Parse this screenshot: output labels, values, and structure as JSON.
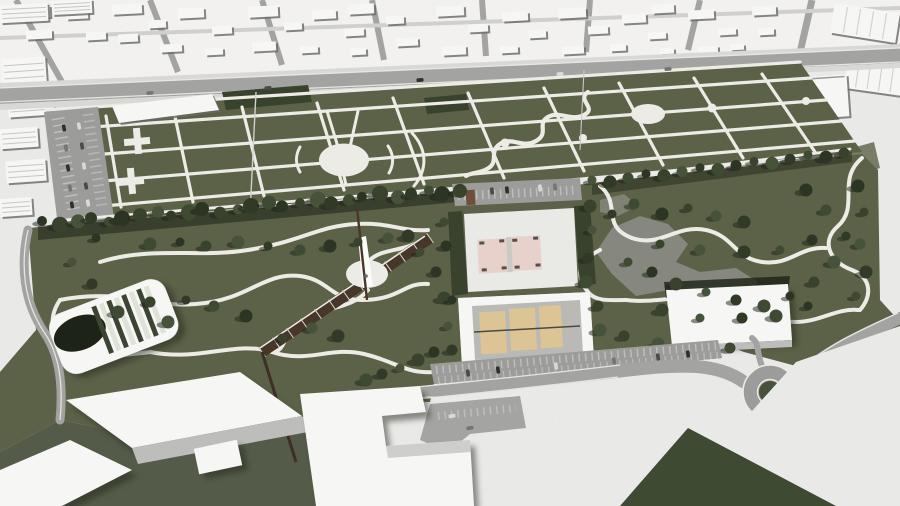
{
  "scene": {
    "description": "Aerial 3D architectural masterplan rendering: white city blocks surround a long urban park with a formal path-grid garden, two circular plazas, a serpentine walk, a forested linear park with amphitheater, observation mast on a round plaza, a diagonal stair ramp, two pink basketball courts, three sand courts, a large white hall, parking lots, a roundabout and large white buildings in the foreground",
    "court_counts": {
      "pink_courts": 2,
      "sand_courts": 3
    },
    "circular_plazas": 2,
    "roundabouts": 1
  },
  "colors": {
    "cityGround": "#e9e9e7",
    "cityBright": "#f2f1ef",
    "buildingWhite": "#f6f6f4",
    "buildingShade": "#bdbdbb",
    "buildingDark": "#4e4e4c",
    "roadGray": "#a3a3a1",
    "asphalt": "#9c9c9a",
    "sidewalk": "#d8d8d6",
    "pathWhite": "#edebe5",
    "parkGreen": "#5c6247",
    "parkGreenDeep": "#4d5539",
    "forestGreen": "#39422c",
    "shadowDeep": "#1d2317",
    "courtPink": "#e8d1ca",
    "courtSand": "#dcc494",
    "courtPadGray": "#b9bab6",
    "rampBrown": "#46372a",
    "kioskBrown": "#6f4e3b",
    "plazaGray": "#8d8e88",
    "carDark": "#2f2f2d",
    "carLight": "#d9d9d7"
  }
}
